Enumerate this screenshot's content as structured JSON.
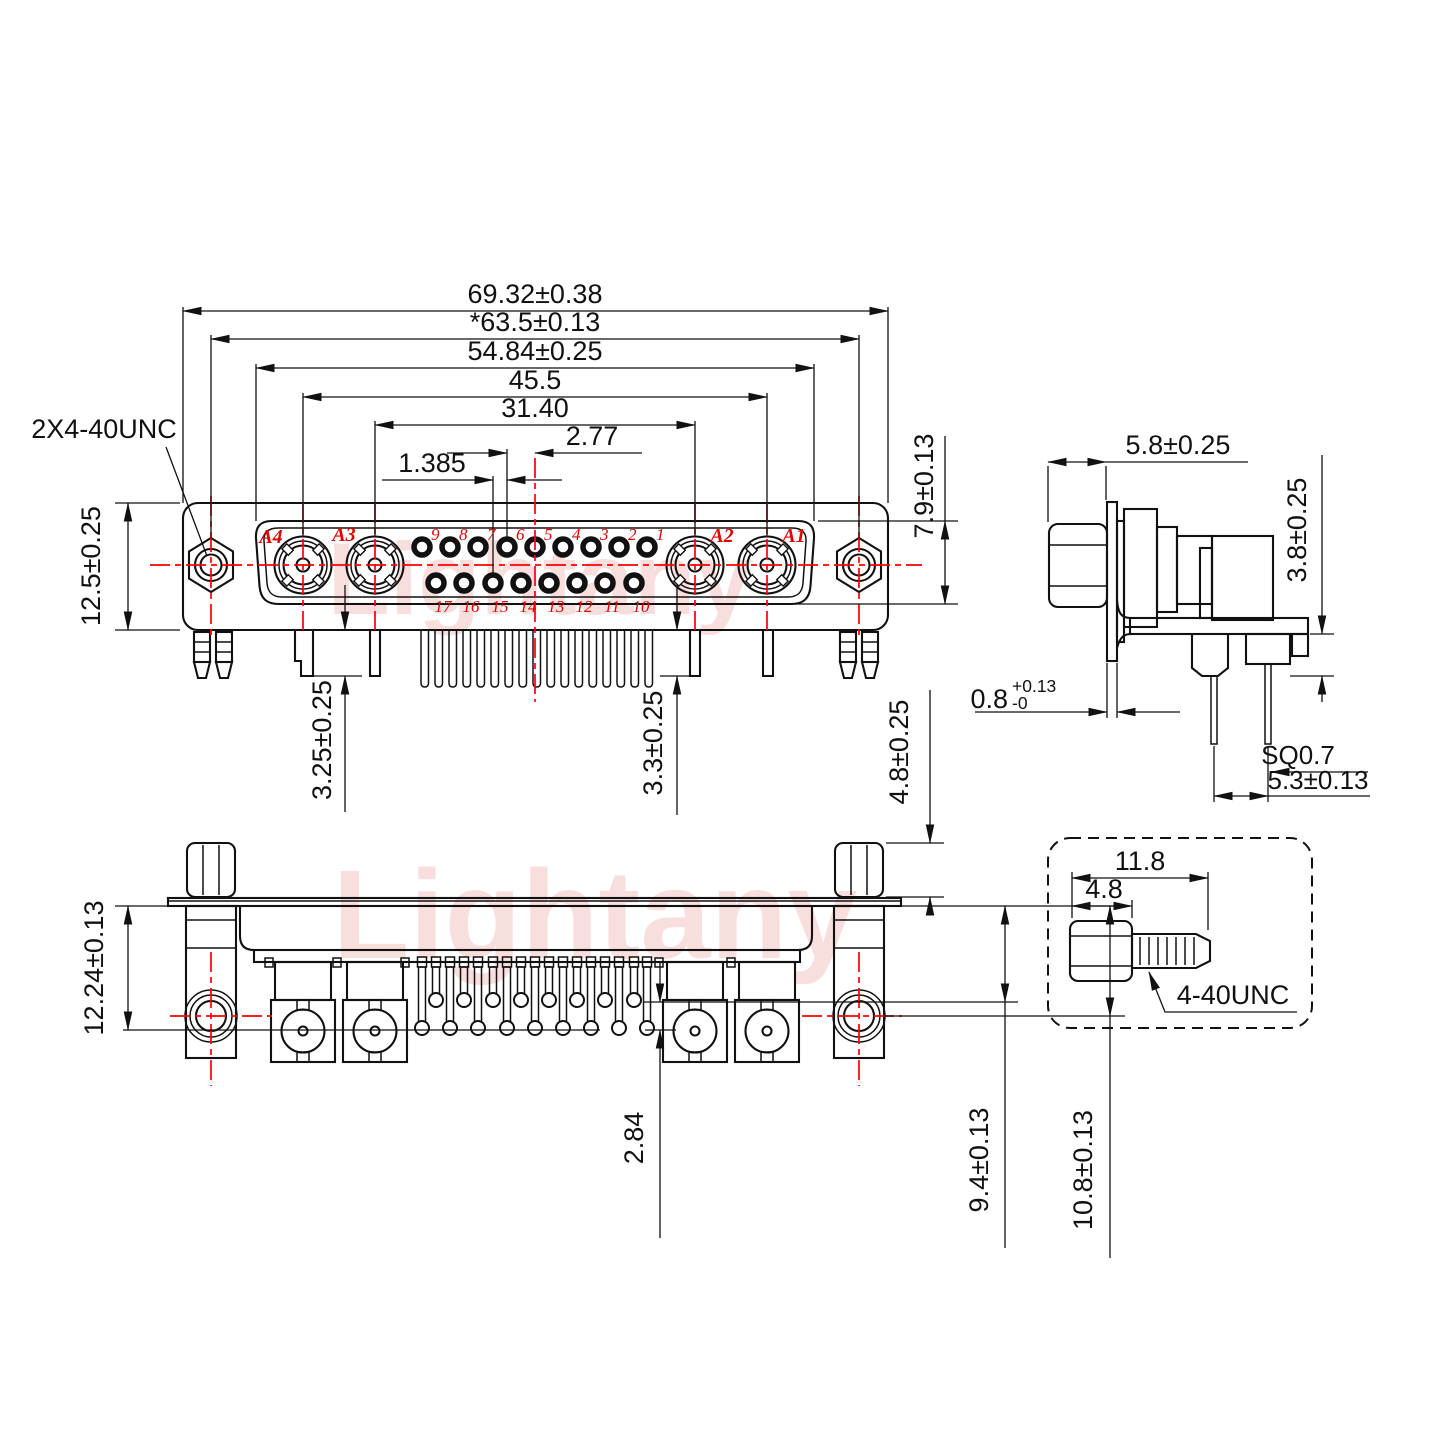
{
  "watermark": {
    "text": "Lightany"
  },
  "front_view": {
    "dims": {
      "overall_width": "69.32±0.38",
      "screw_span": "*63.5±0.13",
      "insert_width": "54.84±0.25",
      "coax_outer_span": "45.5",
      "coax_inner_span": "31.40",
      "pin_pitch": "2.77",
      "row_offset": "1.385",
      "insert_height": "7.9±0.13",
      "body_height": "12.5±0.25",
      "tail_len_a4": "3.25±0.25",
      "tail_len_a2": "3.3±0.25"
    },
    "thread_callout": "2X4-40UNC",
    "coax_labels": [
      "A4",
      "A3",
      "A2",
      "A1"
    ],
    "pin_numbers_top": [
      "9",
      "8",
      "7",
      "6",
      "5",
      "4",
      "3",
      "2",
      "1"
    ],
    "pin_numbers_bottom": [
      "17",
      "16",
      "15",
      "14",
      "13",
      "12",
      "11",
      "10"
    ]
  },
  "side_view": {
    "dims": {
      "front_depth": "5.8±0.25",
      "bracket_height": "3.8±0.25",
      "flange_thickness": "0.8",
      "flange_tol_plus": "+0.13",
      "flange_tol_minus": "-0",
      "pin_square": "SQ0.7",
      "pin_span": "5.3±0.13"
    }
  },
  "bottom_view": {
    "dims": {
      "standoff_height": "4.8±0.25",
      "flange_to_center": "12.24±0.13",
      "row_gap": "2.84",
      "short_pin_reach": "9.4±0.13",
      "hole_center_reach": "10.8±0.13"
    }
  },
  "screw_detail": {
    "dims": {
      "total_length": "11.8",
      "head_length": "4.8"
    },
    "thread_label": "4-40UNC"
  }
}
